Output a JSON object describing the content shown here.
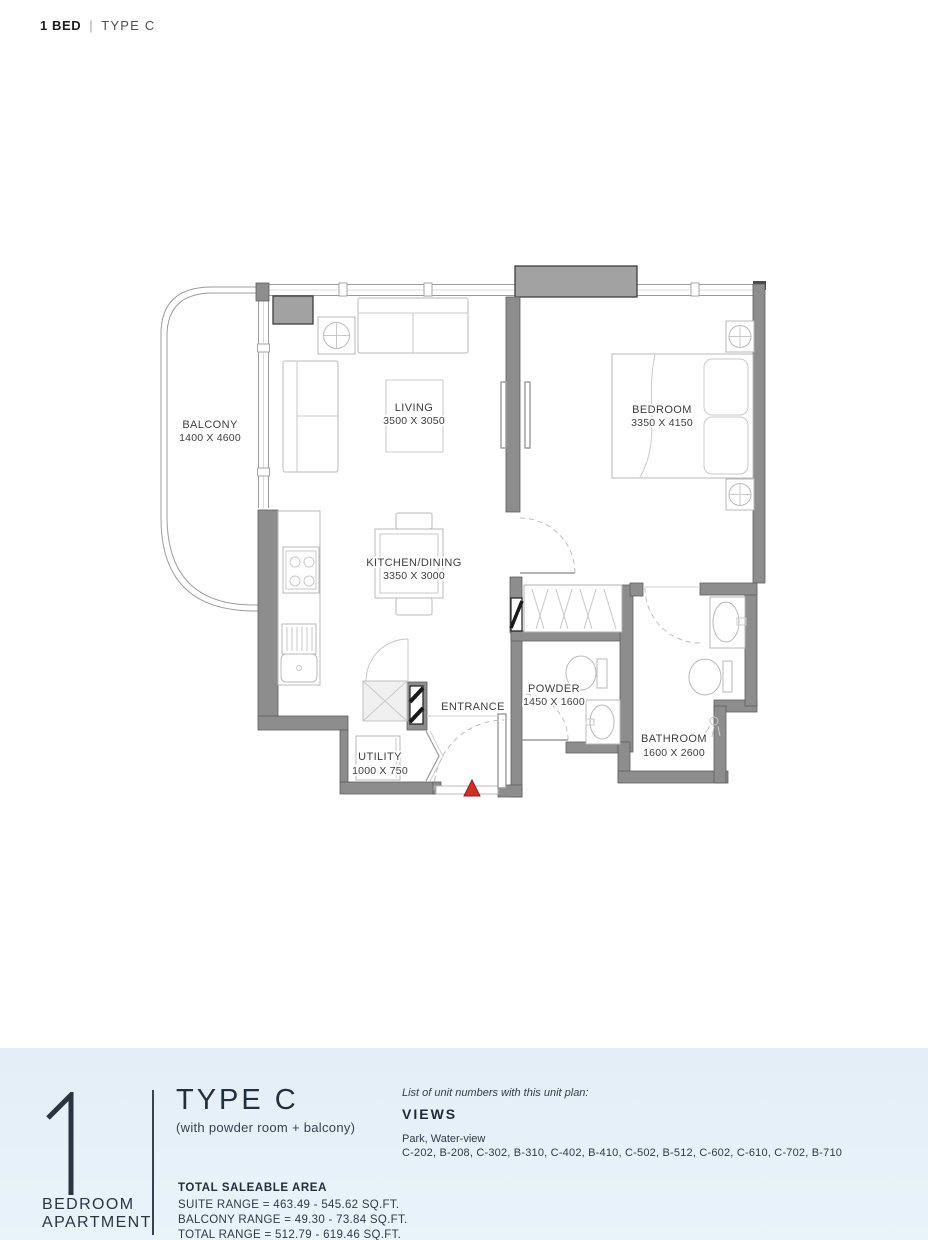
{
  "header": {
    "unit": "1 BED",
    "separator": "|",
    "type": "TYPE C"
  },
  "plan": {
    "rooms": {
      "balcony": {
        "name": "BALCONY",
        "dims": "1400 X 4600"
      },
      "living": {
        "name": "LIVING",
        "dims": "3500 X 3050"
      },
      "bedroom": {
        "name": "BEDROOM",
        "dims": "3350 X 4150"
      },
      "kitchen": {
        "name": "KITCHEN/DINING",
        "dims": "3350 X 3000"
      },
      "powder": {
        "name": "POWDER",
        "dims": "1450 X 1600"
      },
      "bathroom": {
        "name": "BATHROOM",
        "dims": "1600 X 2600"
      },
      "utility": {
        "name": "UTILITY",
        "dims": "1000 X 750"
      },
      "entrance": {
        "name": "ENTRANCE"
      }
    },
    "colors": {
      "wall": "#8d8d8d",
      "column": "#a2a2a2",
      "marker": "#cf2e29"
    }
  },
  "footer": {
    "number": "1",
    "caption_line1": "BEDROOM",
    "caption_line2": "APARTMENT",
    "type_title": "TYPE C",
    "type_subtitle": "(with powder room + balcony)",
    "area_heading": "TOTAL SALEABLE AREA",
    "area_lines": [
      "SUITE RANGE = 463.49 - 545.62 SQ.FT.",
      "BALCONY RANGE = 49.30 - 73.84 SQ.FT.",
      "TOTAL RANGE = 512.79 - 619.46 SQ.FT."
    ],
    "units_intro": "List of unit numbers with this unit plan:",
    "views_heading": "VIEWS",
    "views_value": "Park, Water-view",
    "unit_numbers": "C-202, B-208, C-302, B-310, C-402, B-410, C-502, B-512, C-602, C-610, C-702, B-710"
  }
}
